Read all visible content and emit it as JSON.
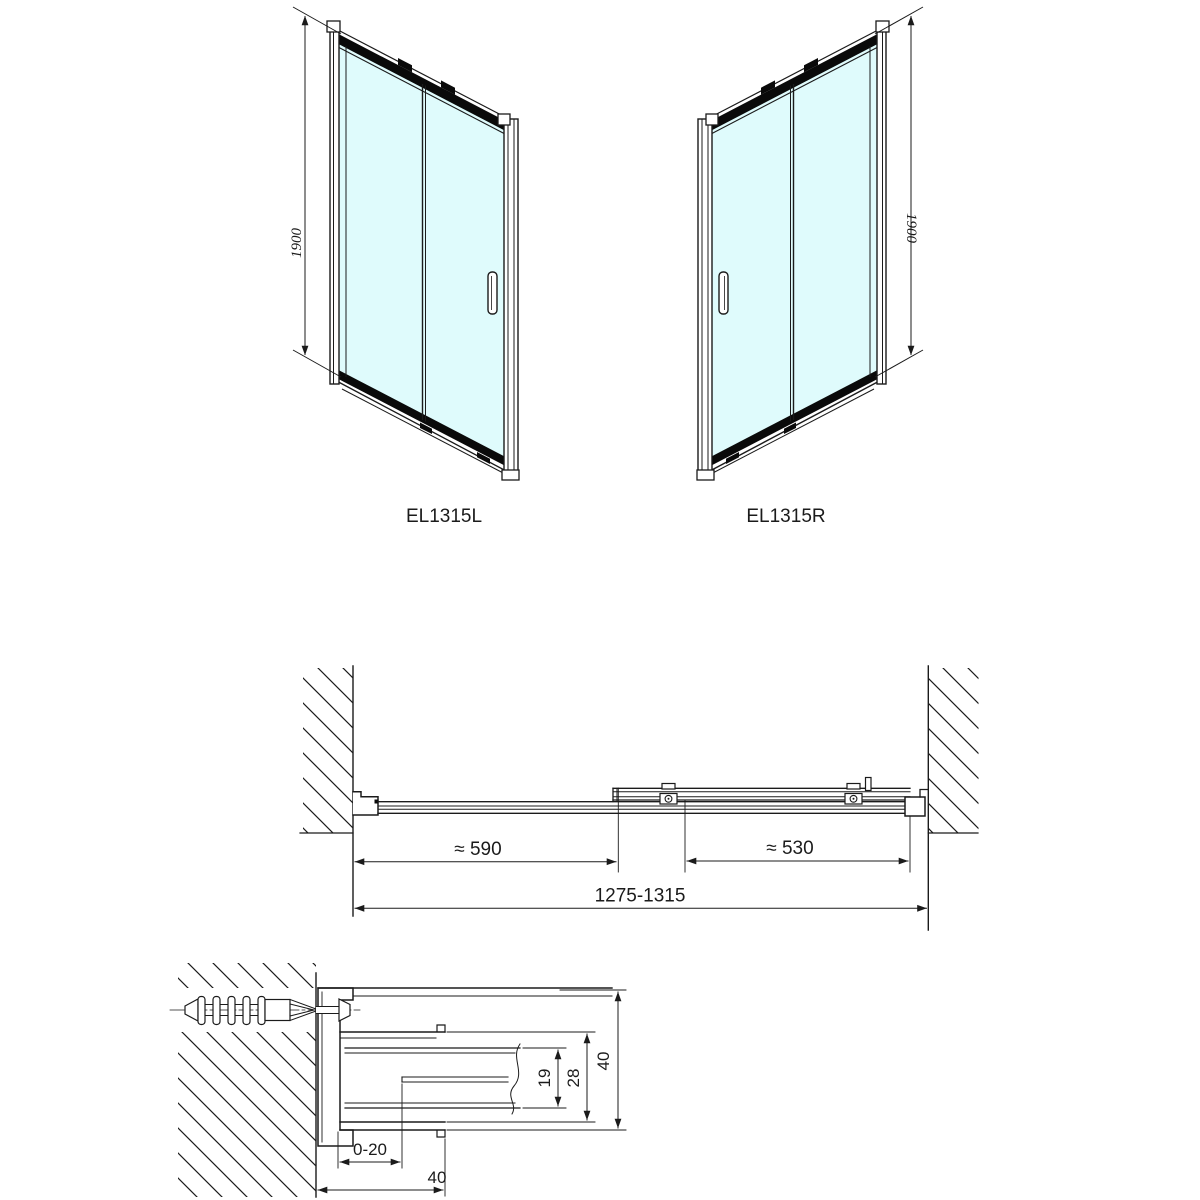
{
  "colors": {
    "line": "#1b1b1b",
    "glass": "#dffbfc",
    "band": "#0a0a0a"
  },
  "front_view_left": {
    "label": "EL1315L",
    "height_dim": "1900"
  },
  "front_view_right": {
    "label": "EL1315R",
    "height_dim": "1900"
  },
  "plan_view": {
    "dim_fixed_panel": "≈ 590",
    "dim_sliding_panel": "≈ 530",
    "dim_overall_width": "1275-1315"
  },
  "section_view": {
    "dim_wall_adjustment": "0-20",
    "dim_wall_profile_depth": "40",
    "dim_glass_channel": "19",
    "dim_channel_outer": "28",
    "dim_profile_depth": "40"
  }
}
